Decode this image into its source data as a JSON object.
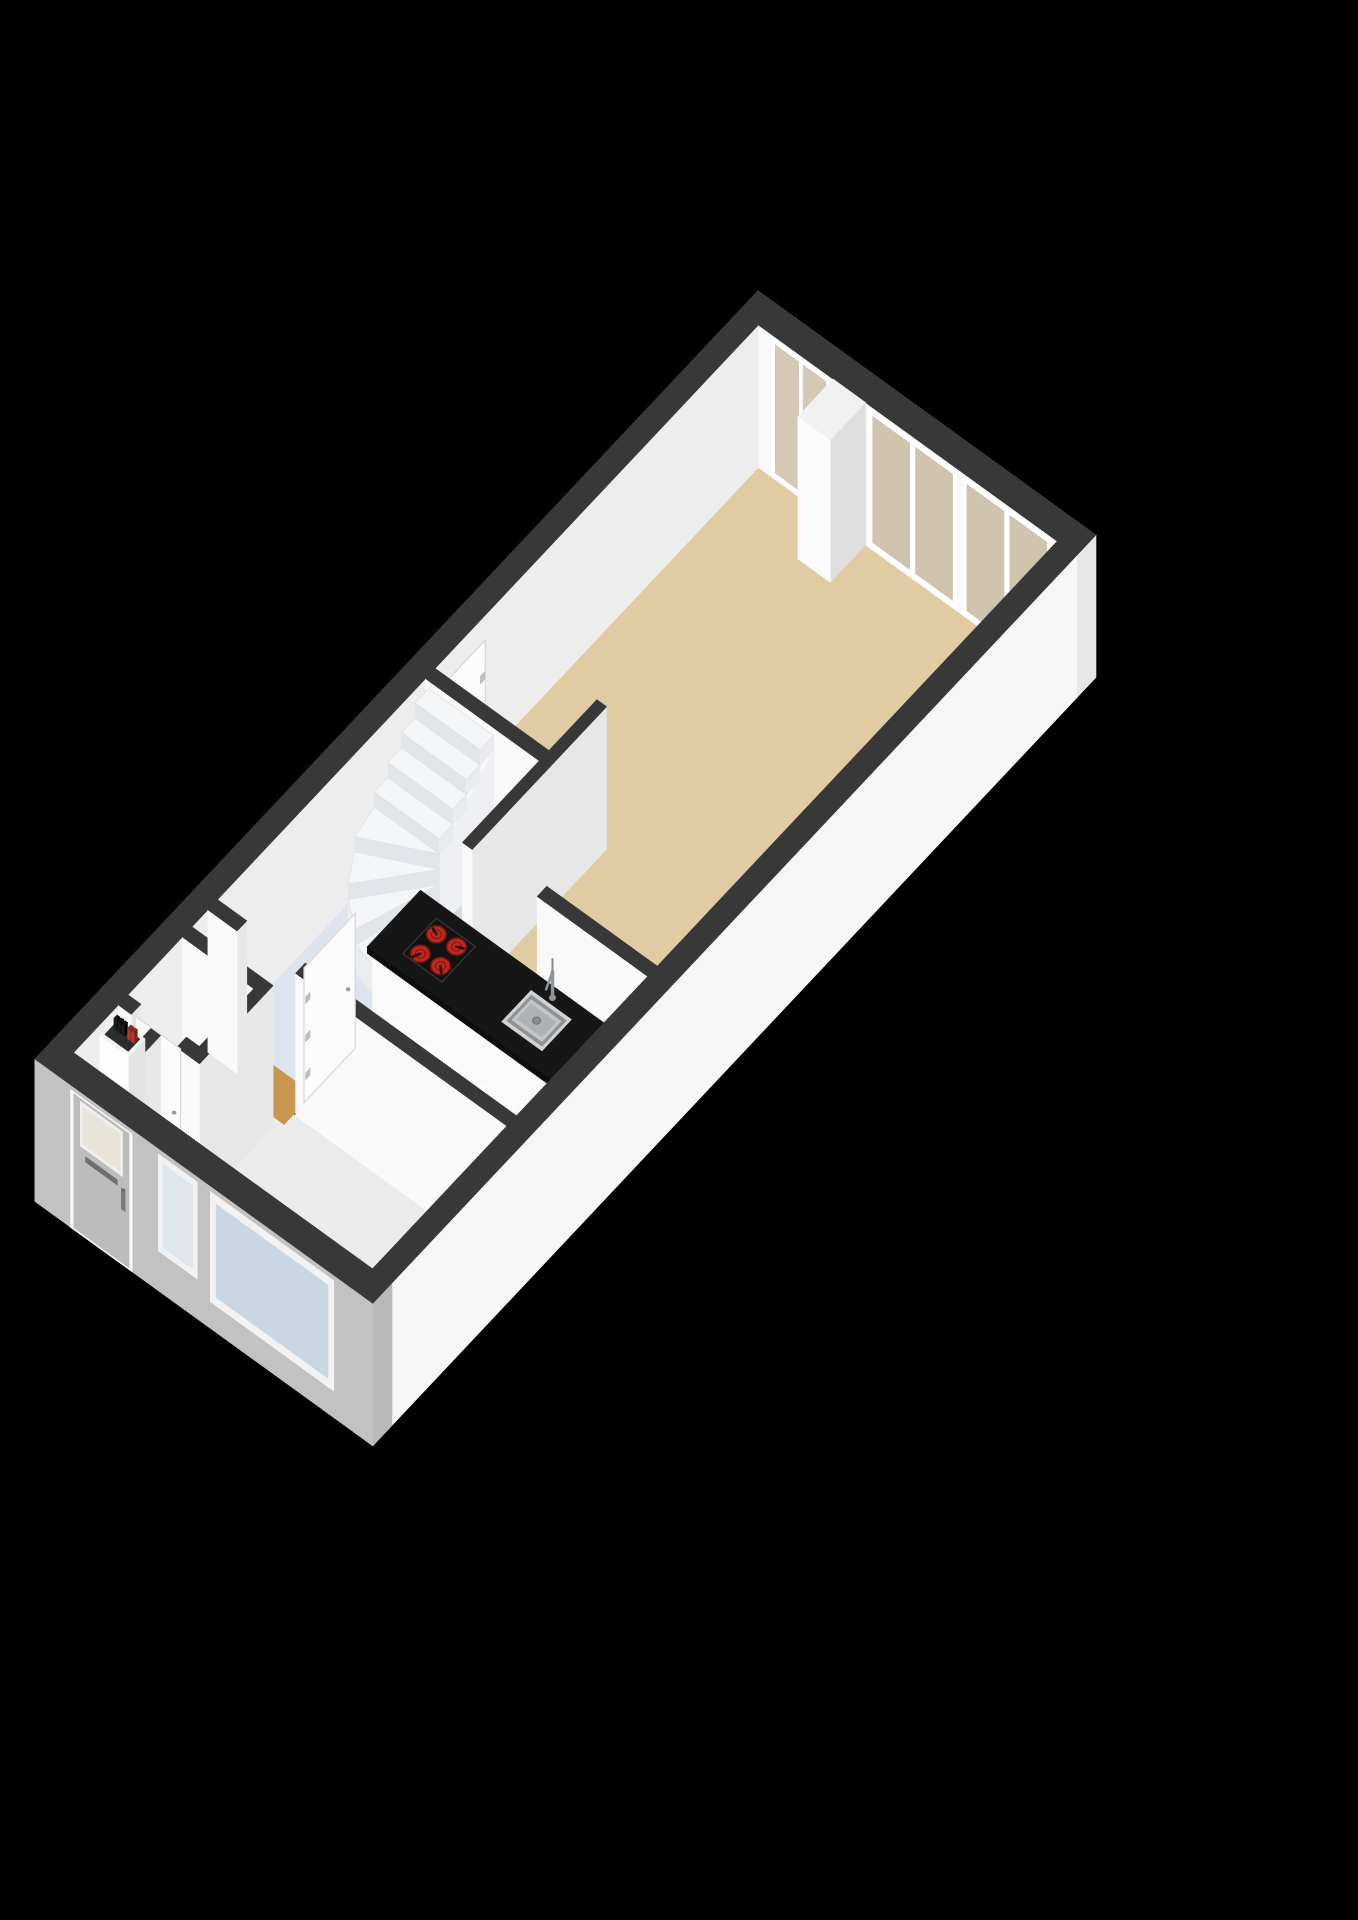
{
  "scene": {
    "description": "3D axonometric floor plan of a ground floor with living room, open kitchen, winder staircase, hallway, toilet and meter cupboard",
    "background": "#000000"
  },
  "palette": {
    "wall_cap": "#383838",
    "wall_bright": "#f9f9f9",
    "wall_shaded": "#e7e7e7",
    "facade_inner": "#ededed",
    "facade_end": "#d4d4d4",
    "facade_front_gray": "#c2c2c2",
    "facade_front_end": "#b9b9b9",
    "facade_side_white": "#f6f6f6",
    "facade_side_end": "#cfcfcf"
  },
  "rooms": [
    {
      "id": "living-room",
      "floor_color": "#e0cba3"
    },
    {
      "id": "kitchen",
      "floor_color": "#dde4ee"
    },
    {
      "id": "hallway",
      "floor_color": "#ebebeb"
    },
    {
      "id": "stairwell",
      "floor_color": "#d8dbe0"
    },
    {
      "id": "toilet",
      "floor_color": "#f2f2f2"
    },
    {
      "id": "meter-cupboard",
      "floor_color": "#ededed"
    }
  ],
  "fixtures": {
    "island": {
      "body": "#fafafa",
      "body_side": "#e9e9e9",
      "top": "#161616",
      "top_front": "#0d0d0d",
      "top_side": "#262626"
    },
    "sink": {
      "rim": "#d2d2d2",
      "groove": "#8e9294",
      "basin": "#c2c6c8",
      "basin_shade": "#aeb2b4",
      "drain": "#878d90",
      "metal": "#969ca0"
    },
    "cooktop": {
      "panel": "#121212",
      "edge": "#3f3f3f",
      "burner_count": 4,
      "burner": "#c4261b",
      "burner_ring": "#7e1a14",
      "needle": "#101010"
    },
    "counter": {
      "body": "#f6f6f6",
      "side": "#e7e7e7",
      "top": "#fcfcfc"
    },
    "staircase": {
      "type": "winder",
      "straight_steps": 4,
      "winder_steps": 4,
      "tread": "#f4f5f7",
      "riser": "#e2e5e9",
      "side": "#e9ebee",
      "stringer": "#eef0f3",
      "drum": "#eaedf0"
    },
    "meter_box": {
      "body": "#fdfdfd",
      "side": "#e3e3e3",
      "top": "#f4f4f4",
      "inset": "#2c2c2c",
      "black_modules": 3,
      "red_modules": 2,
      "black": "#1d1d1d",
      "red": "#b23a2c"
    },
    "wall_column": {
      "front": "#fbfbfb",
      "side": "#dedede",
      "top": "#f1f1f1"
    },
    "closet_door": {
      "leaf": "#fcfcfc",
      "edge": "#d7d7d7",
      "hinge": "#bdbdbd"
    }
  },
  "openings": {
    "rear_glass_door": {
      "glass": "#d3c9b4",
      "frame": "#ffffff"
    },
    "rear_window_1": {
      "glass": "#cfc5ae",
      "frame": "#ffffff"
    },
    "rear_window_2": {
      "glass": "#cfc5ae",
      "frame": "#ffffff"
    },
    "front_door": {
      "leaf": "#bcbcbc",
      "frame": "#f7f7f7",
      "glass": "#e8e4da",
      "glass_frame": "#efefef",
      "mail_slot": "#6f6f6f",
      "handle": "#7a7a7a"
    },
    "front_window_narrow": {
      "glass": "#dfe7ed",
      "frame": "#f2f2f2"
    },
    "front_window_large": {
      "glass": "#c9d7e3",
      "frame": "#f2f2f2"
    },
    "interior_door": {
      "leaf": "#fbfbfb",
      "edge": "#d8d8d8",
      "handle": "#9a9a9a"
    },
    "threshold_wood": "#c8964f"
  }
}
